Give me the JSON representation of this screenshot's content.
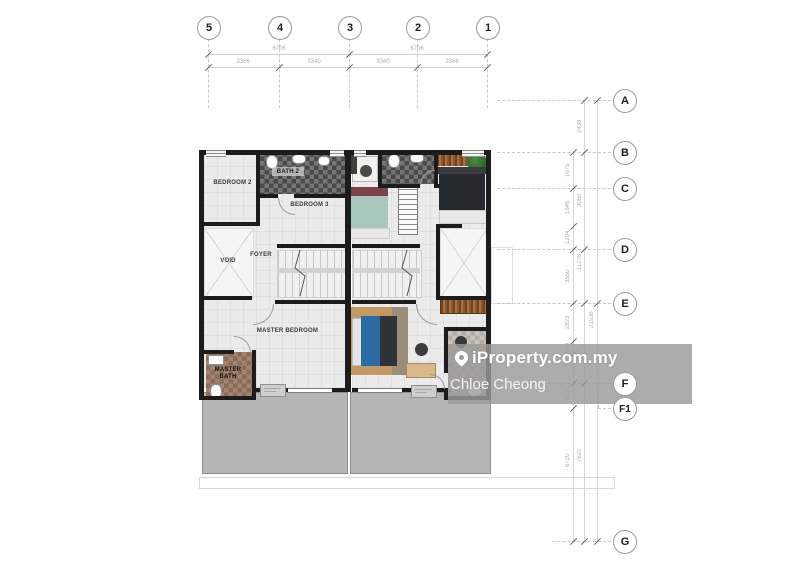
{
  "watermark": {
    "brand": "iProperty.com.my",
    "agent": "Chloe Cheong"
  },
  "grid": {
    "columns": [
      "5",
      "4",
      "3",
      "2",
      "1"
    ],
    "rows": [
      "A",
      "B",
      "C",
      "D",
      "E",
      "F",
      "F1",
      "G"
    ]
  },
  "dimensions": {
    "top_row1": [
      "6706",
      "6706"
    ],
    "top_row2": [
      "3366",
      "3340",
      "3340",
      "3366"
    ],
    "right": [
      "2438",
      "1675",
      "1846",
      "3050",
      "1204",
      "3550",
      "11278",
      "2823",
      "21536",
      "600",
      "821",
      "6720",
      "7620"
    ]
  },
  "rooms": {
    "bedroom2": "BEDROOM 2",
    "bath2": "BATH 2",
    "bedroom3": "BEDROOM 3",
    "void": "VOID",
    "foyer": "FOYER",
    "master_bedroom": "MASTER BEDROOM",
    "master_bath": "MASTER BATH"
  },
  "colors": {
    "wall": "#1c1c1c",
    "balcony": "#b6b6b6",
    "floor": "#ebebeb",
    "watermark_band": "rgba(154,154,154,0.82)"
  }
}
